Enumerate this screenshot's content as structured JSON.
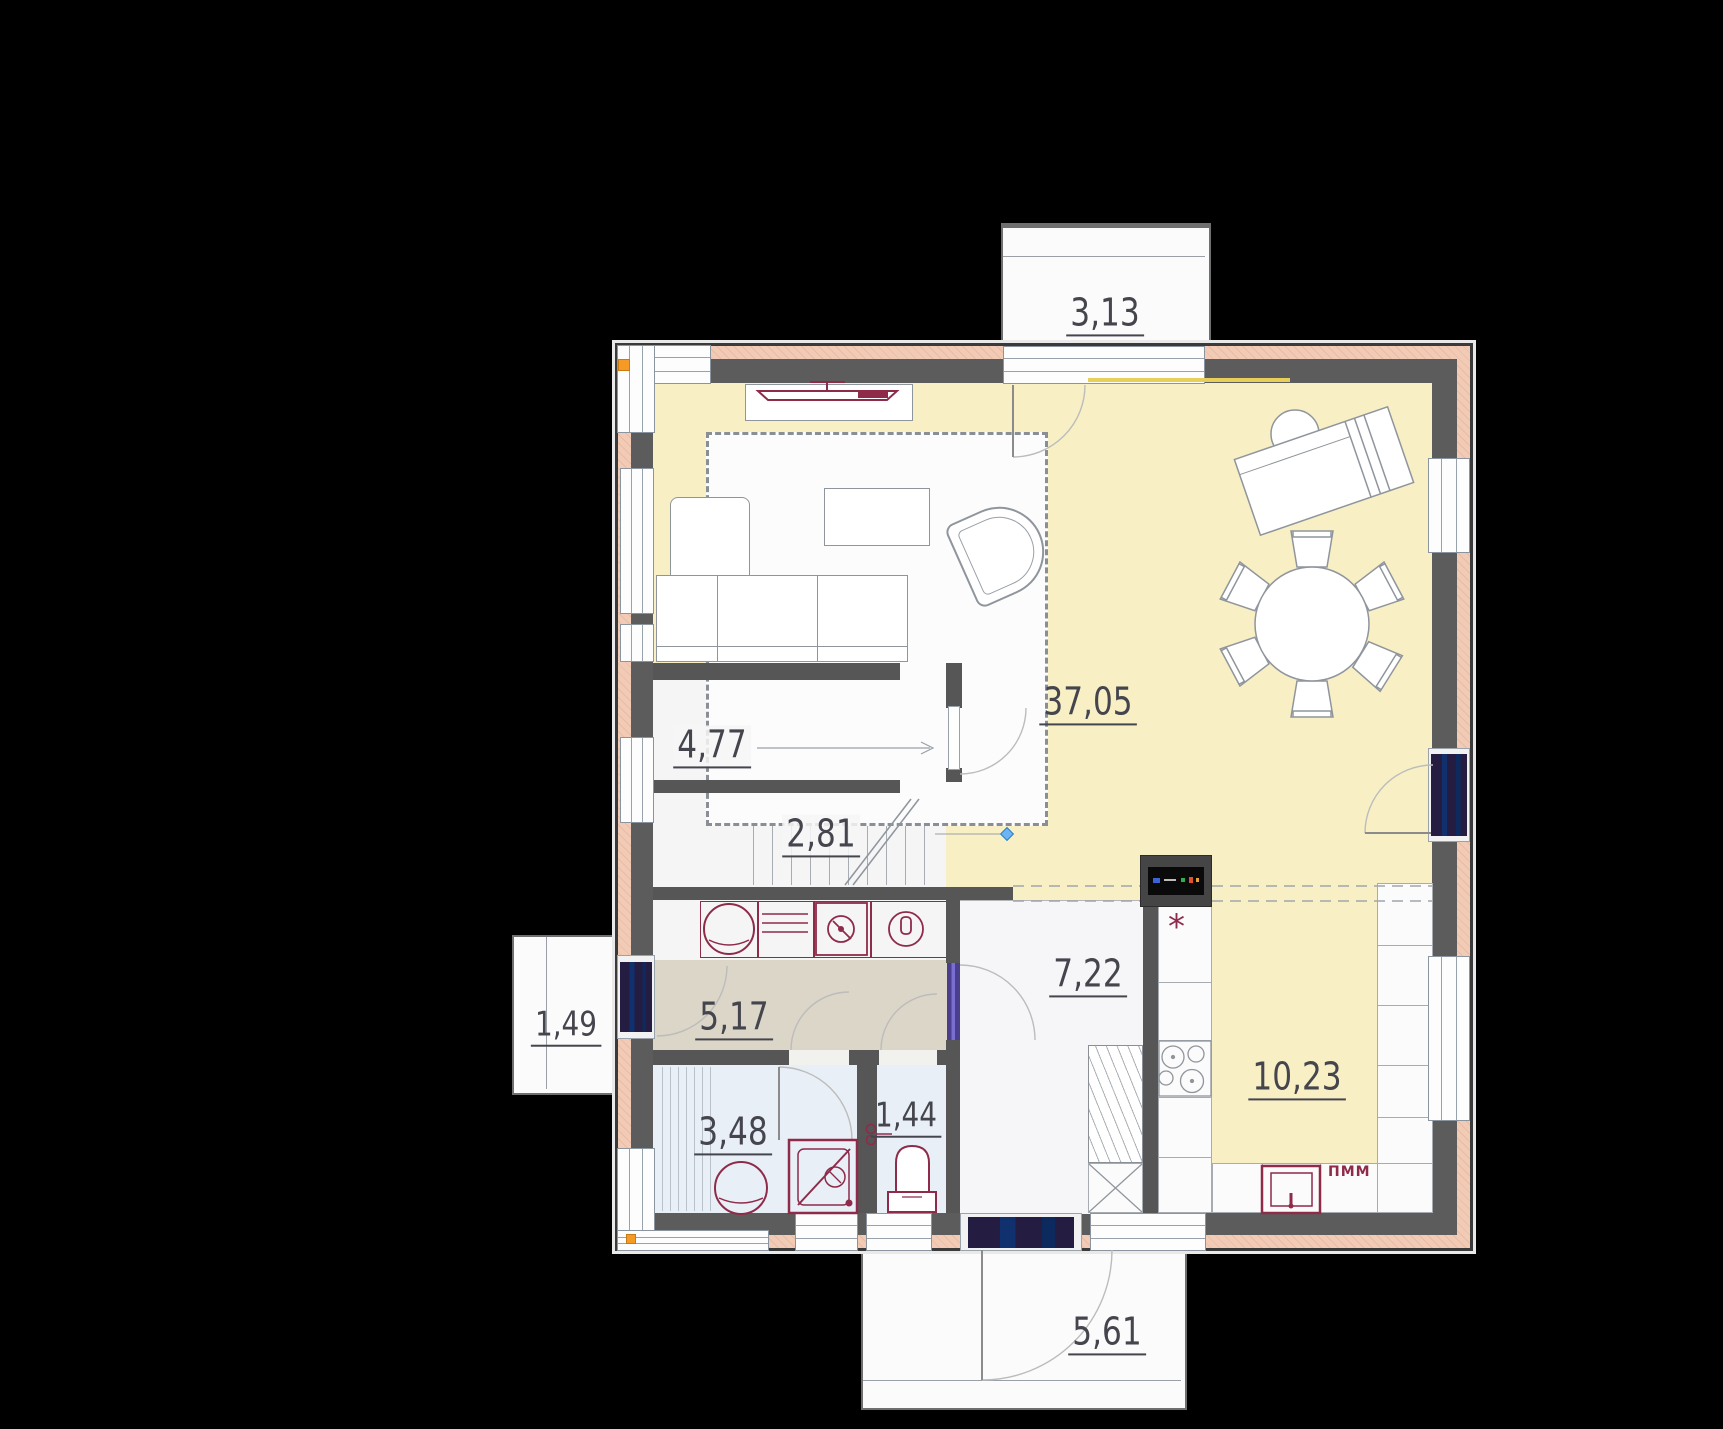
{
  "plan_type": "floor-plan",
  "rooms": {
    "balcony": {
      "label": "3,13"
    },
    "living": {
      "label": "37,05"
    },
    "stair_upper": {
      "label": "4,77"
    },
    "stair_lower": {
      "label": "2,81"
    },
    "porch": {
      "label": "1,49"
    },
    "hallway": {
      "label": "5,17"
    },
    "hall_room": {
      "label": "7,22"
    },
    "kitchen": {
      "label": "10,23"
    },
    "bathroom": {
      "label": "3,48"
    },
    "wc": {
      "label": "1,44"
    },
    "terrace": {
      "label": "5,61"
    }
  },
  "annotations": {
    "dishwasher_label": "ПММ",
    "hob_marker": "*"
  },
  "colors": {
    "floor_main": "#f8efc5",
    "floor_hallway": "#dcd6c8",
    "floor_wet": "#e9eff7",
    "wall_core": "#5c5c5c",
    "wall_insulation": "#f2cbb6",
    "fixture_accent": "#8e2b49",
    "label_text": "#45454d",
    "corner_marker": "#f59b25",
    "cad_node_marker": "#6cb5f2"
  }
}
